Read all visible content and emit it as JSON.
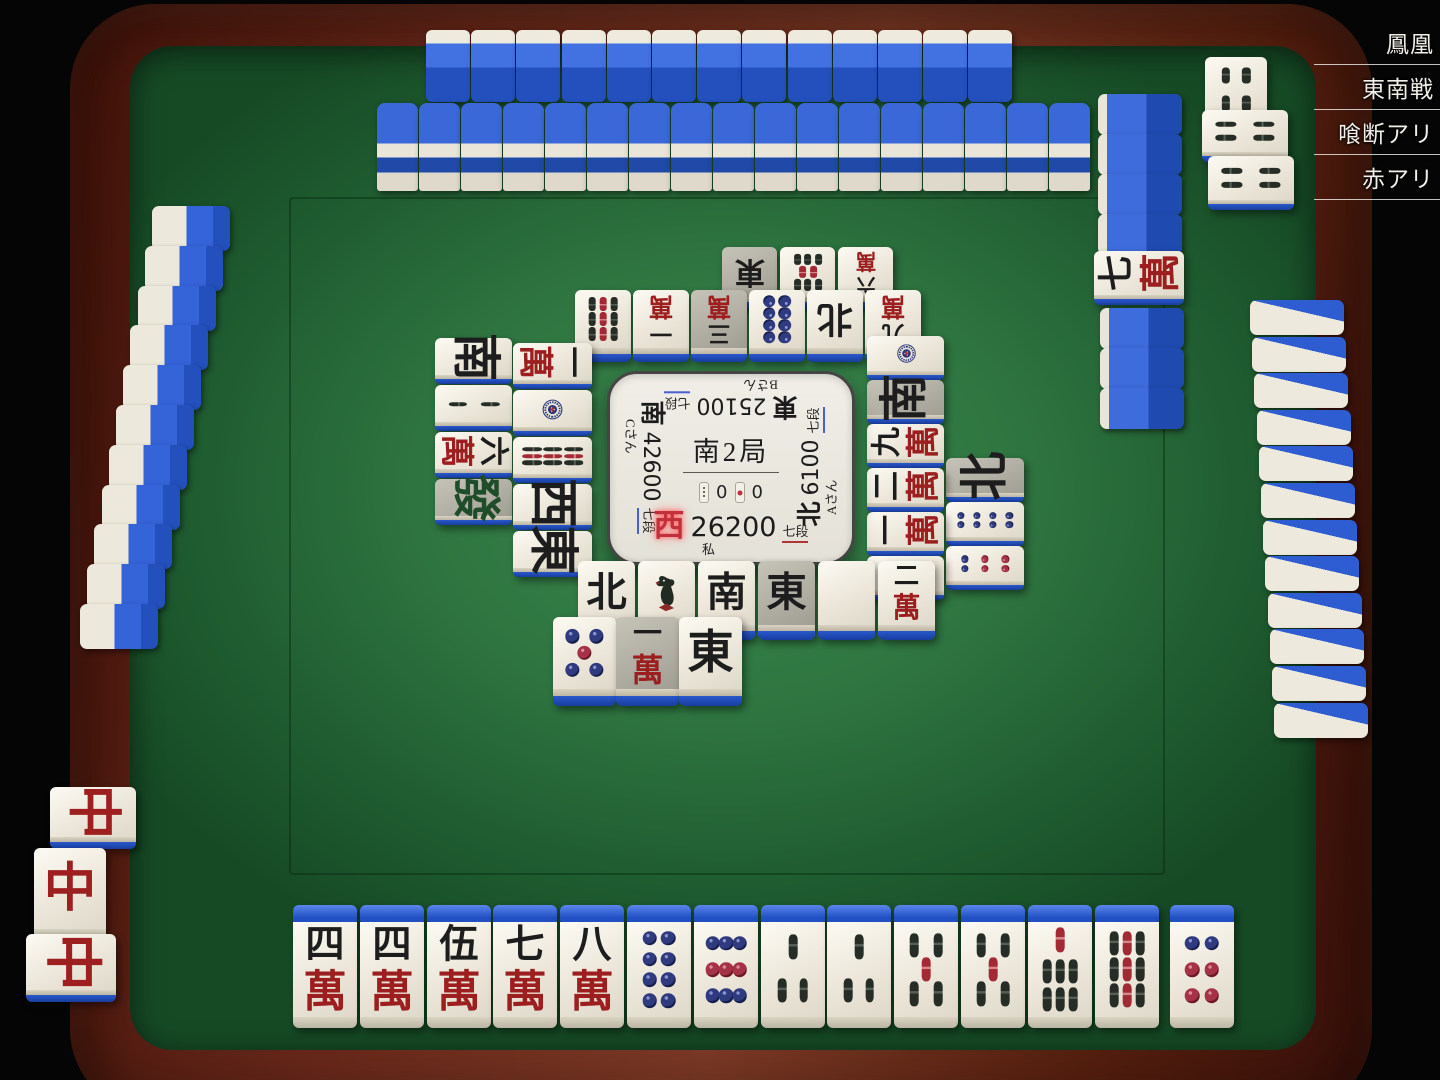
{
  "room": {
    "name": "鳳凰",
    "rules": [
      "東南戦",
      "喰断アリ",
      "赤アリ"
    ]
  },
  "center_panel": {
    "round": "南2局",
    "honba_count": "0",
    "riichi_count": "0",
    "players": {
      "self": {
        "wind": "西",
        "score": "26200",
        "rank": "七段",
        "name": "私"
      },
      "left": {
        "wind": "南",
        "score": "42600",
        "rank": "七段",
        "name": "Cさん"
      },
      "top": {
        "wind": "東",
        "score": "25100",
        "rank": "七段",
        "name": "Bさん"
      },
      "right": {
        "wind": "北",
        "score": "6100",
        "rank": "七段",
        "name": "Aさん"
      }
    }
  },
  "hand": {
    "tiles": [
      "4m",
      "4m",
      "5m",
      "7m",
      "8m",
      "8p",
      "9p",
      "3s",
      "3s",
      "5s",
      "5s",
      "7s",
      "9s"
    ],
    "drawn": "6p"
  },
  "melds": {
    "self": {
      "type": "pon",
      "tiles": [
        {
          "code": "C",
          "rot": 90
        },
        {
          "code": "C",
          "rot": 0
        },
        {
          "code": "C",
          "rot": 90
        }
      ]
    },
    "right": {
      "type": "pon",
      "tiles": [
        {
          "code": "4s",
          "rot": 0
        },
        {
          "code": "4s",
          "rot": -90
        },
        {
          "code": "4s",
          "rot": -90
        }
      ]
    }
  },
  "dora_indicator": "7m",
  "ponds": {
    "self": {
      "rows": [
        [
          "N",
          "1s",
          "S",
          "E|g",
          "haku",
          "2m"
        ],
        [
          "5p",
          "1m|g",
          "E"
        ]
      ]
    },
    "top": {
      "rows": [
        [
          "9s",
          "1m",
          "3m|g",
          "8p",
          "N",
          "9m"
        ],
        [
          "E|g",
          "8s",
          "6m"
        ]
      ]
    },
    "left": {
      "cols": [
        [
          "1m",
          "1p",
          "9s",
          "W",
          "E"
        ],
        [
          "S",
          "2s",
          "6m",
          "F|g"
        ]
      ]
    },
    "right": {
      "cols": [
        [
          "1p",
          "S|g",
          "9m",
          "2m",
          "1m",
          "1s"
        ],
        [
          "N|g",
          "8p",
          "6p"
        ]
      ]
    }
  },
  "walls": {
    "top_hand": 13,
    "top_wall": 17,
    "left_hand": 11,
    "right_hand": 12,
    "right_wall_top": 4,
    "right_wall_bottom": 3
  },
  "glyphs": {
    "man_numbers": [
      "一",
      "二",
      "三",
      "四",
      "伍",
      "六",
      "七",
      "八",
      "九"
    ],
    "man_suit": "萬",
    "east": "東",
    "south": "南",
    "west": "西",
    "north": "北",
    "hatsu": "發",
    "chun": "中"
  },
  "colors": {
    "felt": "#2e7440",
    "tile_back": "#2a58cc",
    "wood": "#6b2a1a",
    "gray_tile": "#b3b0a6",
    "wind_highlight": "#c2303c",
    "underline_blue": "#4a5fd0",
    "underline_red": "#b03636",
    "man_red": "#9c1e1e",
    "pin_blue": "#303a7e",
    "pin_red": "#a53246",
    "sou_black": "#262d26",
    "sou_red": "#a32a34",
    "hatsu_green": "#1f4d2a"
  }
}
